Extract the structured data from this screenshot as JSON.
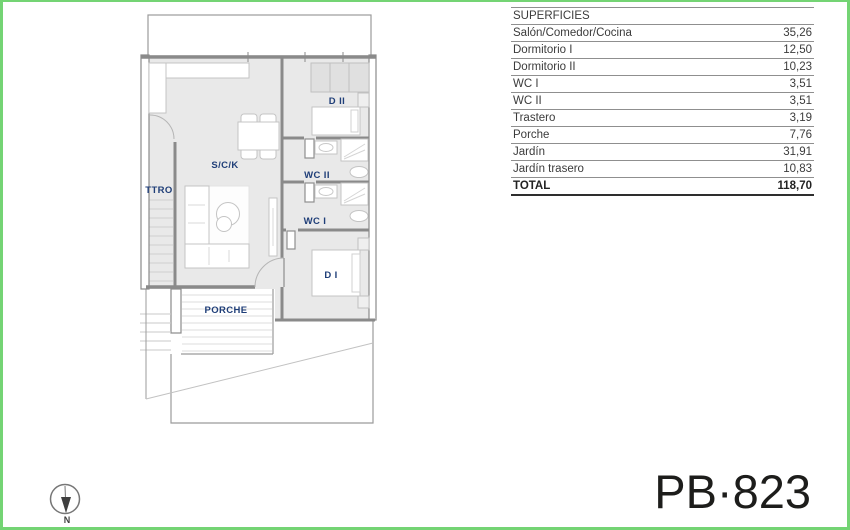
{
  "page": {
    "border_color": "#74d474",
    "plan_code": "PB·823"
  },
  "superficies_table": {
    "title": "SUPERFICIES",
    "rows": [
      {
        "label": "Salón/Comedor/Cocina",
        "value": "35,26"
      },
      {
        "label": "Dormitorio I",
        "value": "12,50"
      },
      {
        "label": "Dormitorio II",
        "value": "10,23"
      },
      {
        "label": "WC I",
        "value": "3,51"
      },
      {
        "label": "WC II",
        "value": "3,51"
      },
      {
        "label": "Trastero",
        "value": "3,19"
      },
      {
        "label": "Porche",
        "value": "7,76"
      },
      {
        "label": "Jardín",
        "value": "31,91"
      },
      {
        "label": "Jardín trasero",
        "value": "10,83"
      }
    ],
    "total_label": "TOTAL",
    "total_value": "118,70"
  },
  "floorplan": {
    "labels": {
      "living_kitchen": "S/C/K",
      "bedroom2": "D II",
      "wc2": "WC II",
      "wc1": "WC I",
      "bedroom1": "D I",
      "storage": "TTRO",
      "porch": "PORCHE"
    },
    "compass_label": "N"
  }
}
